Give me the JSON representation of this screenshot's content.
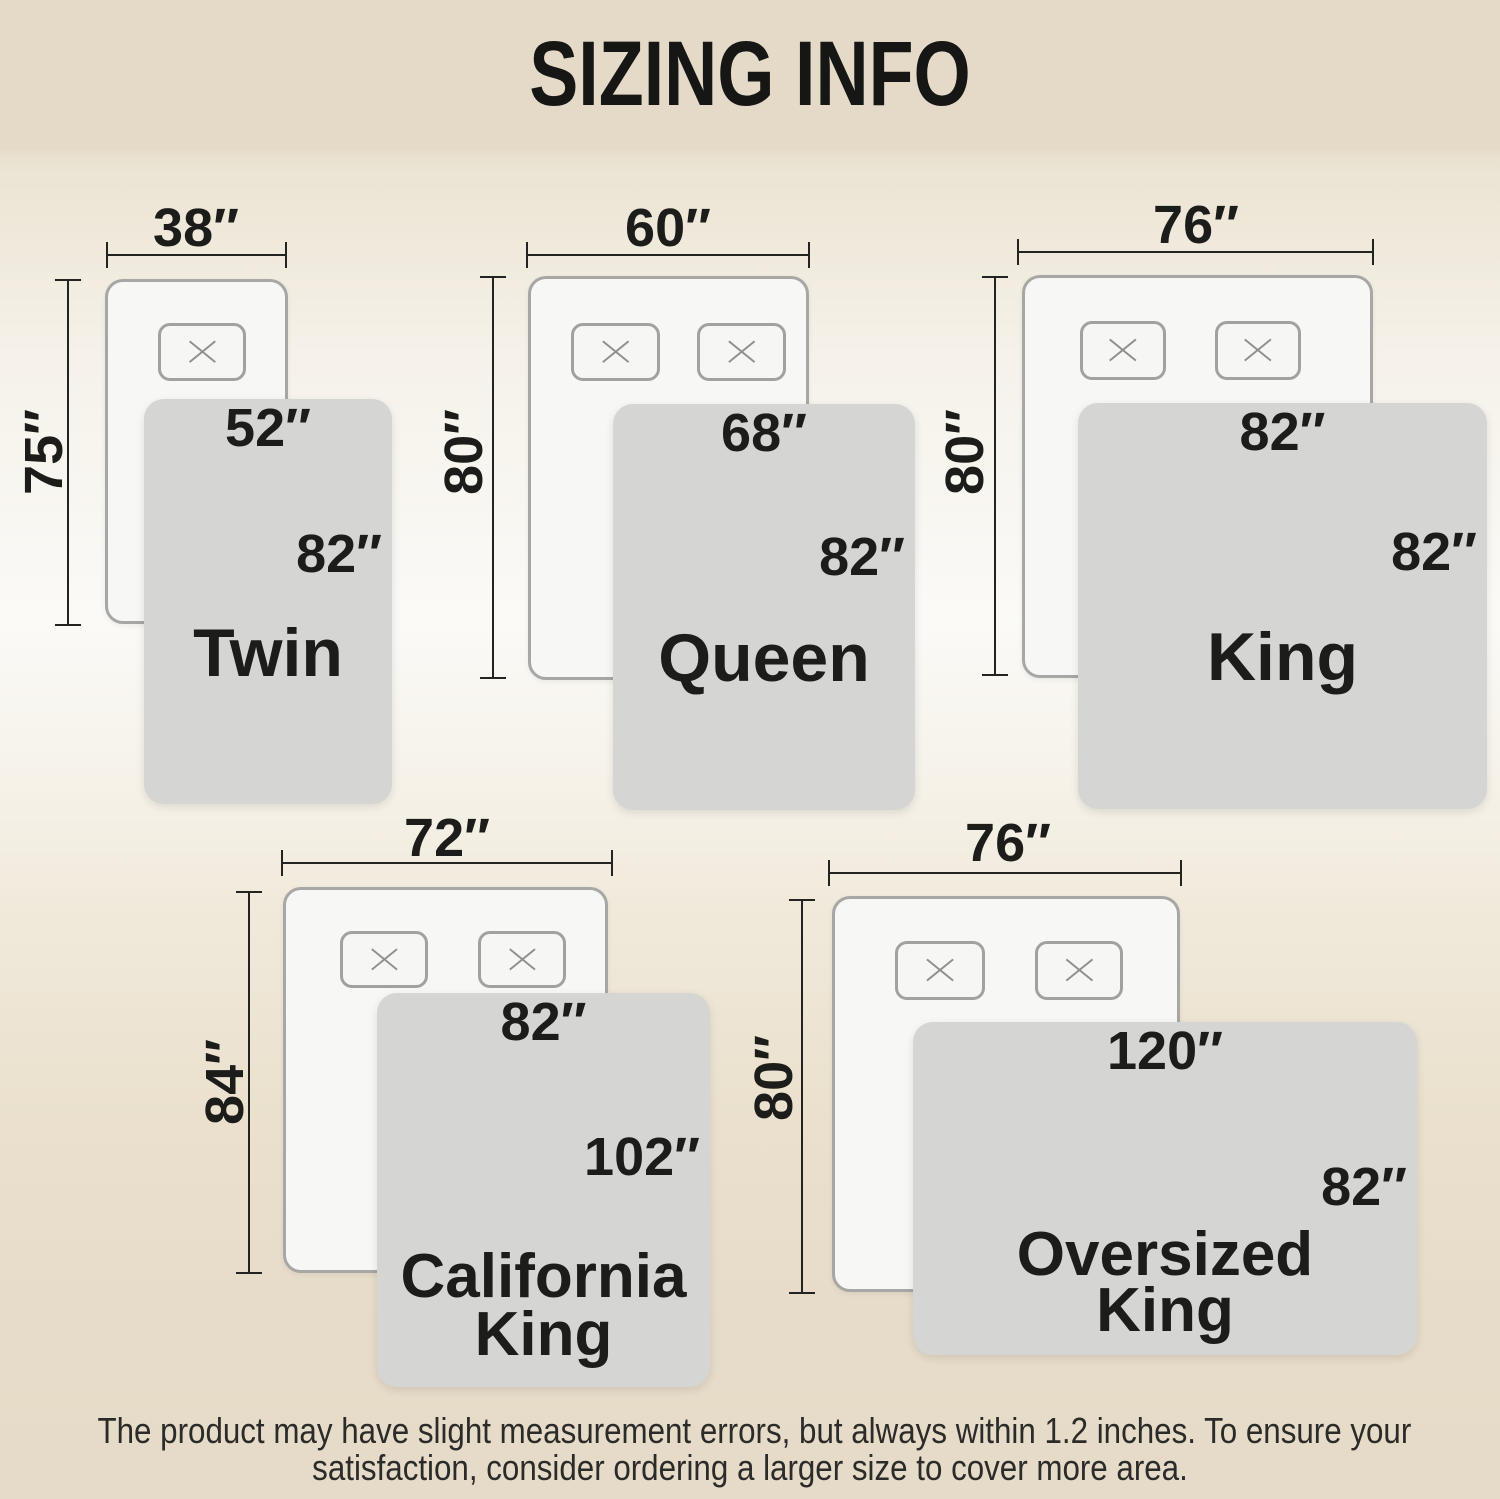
{
  "header": {
    "title": "SIZING INFO"
  },
  "colors": {
    "header_band": "#e4dac7",
    "background_mid": "#fbfaf7",
    "mattress": "#f7f7f5",
    "blanket": "#d5d5d3",
    "text": "#1c1c1a"
  },
  "icons": {
    "pillow_marker": "x-icon"
  },
  "beds": [
    {
      "id": "twin",
      "name": "Twin",
      "mattress_width": "38″",
      "mattress_length": "75″",
      "blanket_width": "52″",
      "blanket_length": "82″",
      "pillows": 1
    },
    {
      "id": "queen",
      "name": "Queen",
      "mattress_width": "60″",
      "mattress_length": "80″",
      "blanket_width": "68″",
      "blanket_length": "82″",
      "pillows": 2
    },
    {
      "id": "king",
      "name": "King",
      "mattress_width": "76″",
      "mattress_length": "80″",
      "blanket_width": "82″",
      "blanket_length": "82″",
      "pillows": 2
    },
    {
      "id": "california-king",
      "name": "California King",
      "name_lines": [
        "California",
        "King"
      ],
      "mattress_width": "72″",
      "mattress_length": "84″",
      "blanket_width": "82″",
      "blanket_length": "102″",
      "pillows": 2
    },
    {
      "id": "oversized-king",
      "name": "Oversized King",
      "name_lines": [
        "Oversized",
        "King"
      ],
      "mattress_width": "76″",
      "mattress_length": "80″",
      "blanket_width": "120″",
      "blanket_length": "82″",
      "pillows": 2
    }
  ],
  "footer": {
    "line1": "The product may have slight measurement errors, but always within 1.2 inches. To ensure your",
    "line2": "satisfaction, consider ordering a larger size to cover more area."
  }
}
